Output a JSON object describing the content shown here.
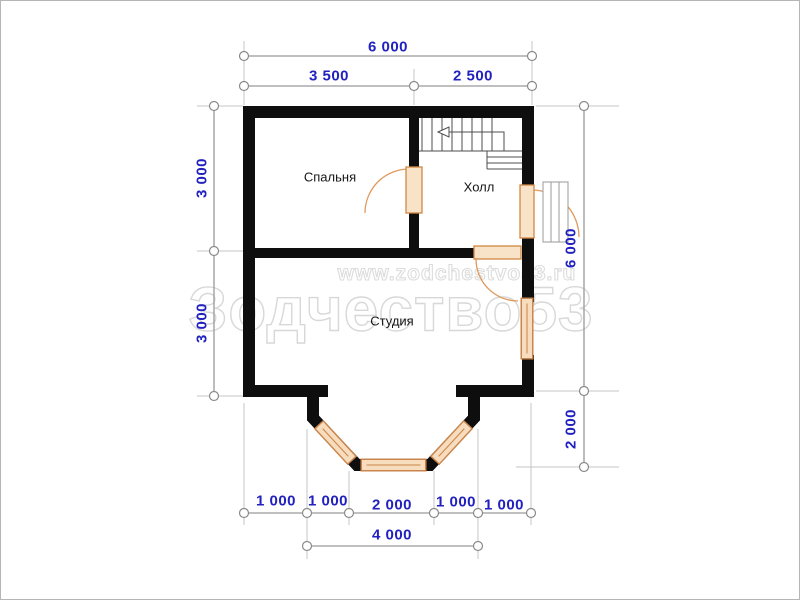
{
  "watermark": {
    "brand": "Зодчество53",
    "url": "www.zodchestvo53.ru"
  },
  "rooms": {
    "bedroom": "Спальня",
    "hall": "Холл",
    "studio": "Студия"
  },
  "dimensions": {
    "top": {
      "overall": "6 000",
      "left_segment": "3 500",
      "right_segment": "2 500"
    },
    "left": {
      "upper": "3 000",
      "lower": "3 000"
    },
    "right": {
      "main": "6 000",
      "bay": "2 000"
    },
    "bottom": {
      "seg1": "1 000",
      "seg2": "1 000",
      "seg3": "2 000",
      "seg4": "1 000",
      "seg5": "1 000",
      "overall": "4 000"
    }
  },
  "colors": {
    "walls": "#0e0e0e",
    "dimension_text": "#2121c0",
    "dimension_lines": "#999999",
    "extension_lines": "#c4c4c4",
    "joinery_stroke": "#c9854d",
    "joinery_fill": "#f7ddbd",
    "stairs": "#4d4d4d",
    "watermark": "#d8d8d8"
  }
}
